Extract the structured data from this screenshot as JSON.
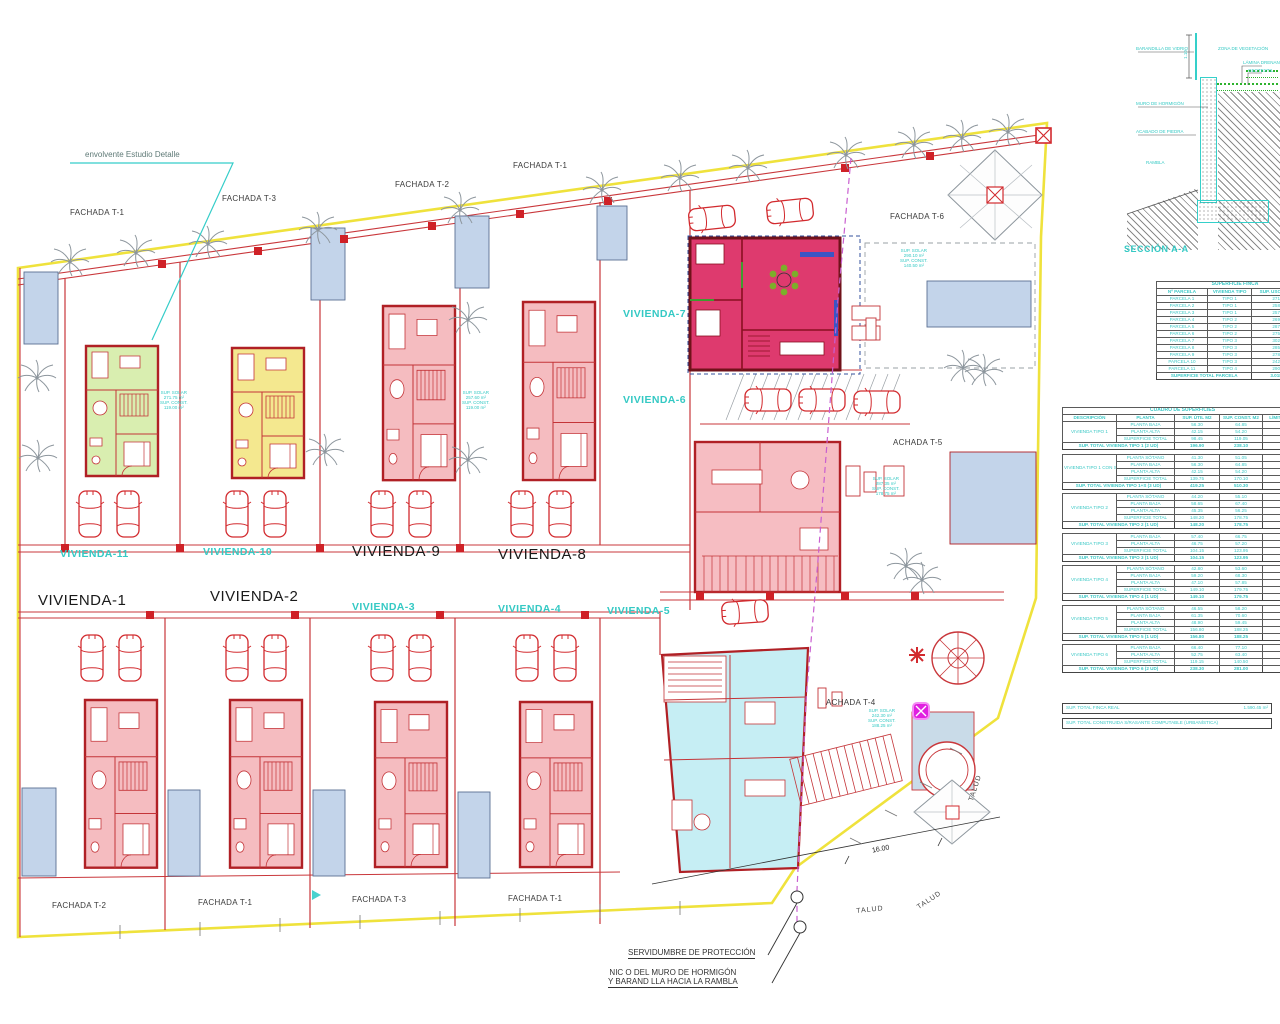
{
  "plan": {
    "viviendas": {
      "v1": "VIVIENDA-1",
      "v2": "VIVIENDA-2",
      "v3": "VIVIENDA-3",
      "v4": "VIVIENDA-4",
      "v5": "VIVIENDA-5",
      "v6": "VIVIENDA-6",
      "v7": "VIVIENDA-7",
      "v8": "VIVIENDA-8",
      "v9": "VIVIENDA-9",
      "v10": "VIVIENDA-10",
      "v11": "VIVIENDA-11"
    },
    "fachadas": {
      "top1": "FACHADA T-1",
      "top3": "FACHADA T-3",
      "top2": "FACHADA T-2",
      "top1b": "FACHADA T-1",
      "t6": "FACHADA T-6",
      "t5": "ACHADA T-5",
      "t4": "ACHADA T-4",
      "bot2": "FACHADA T-2",
      "bot1a": "FACHADA T-1",
      "bot3": "FACHADA T-3",
      "bot1b": "FACHADA T-1"
    },
    "notes": {
      "envolvente": "envolvente Estudio Detalle",
      "servidumbre": "SERVIDUMBRE DE PROTECCIÓN",
      "muro1": "NIC O DEL MURO DE HORMIGÓN",
      "muro2": "Y BARAND LLA HACIA LA RAMBLA",
      "dim": "16.00",
      "talud": "TALUD"
    },
    "annotations": [
      {
        "l1": "SUP. SOLAR",
        "l2": "271.75 m²",
        "l3": "SUP. CONST.",
        "l4": "119.00 m²"
      },
      {
        "l1": "SUP. SOLAR",
        "l2": "257.60 m²",
        "l3": "SUP. CONST.",
        "l4": "119.00 m²"
      },
      {
        "l1": "SUP. SOLAR",
        "l2": "290.10 m²",
        "l3": "SUP. CONST.",
        "l4": "140.50 m²"
      },
      {
        "l1": "SUP. SOLAR",
        "l2": "287.35 m²",
        "l3": "SUP. CONST.",
        "l4": "178.75 m²"
      },
      {
        "l1": "SUP. SOLAR",
        "l2": "242.30 m²",
        "l3": "SUP. CONST.",
        "l4": "188.25 m²"
      }
    ]
  },
  "section": {
    "title": "SECCIÓN A-A",
    "dim": "1.10",
    "l1": "BARANDILLA DE VIDRIO",
    "l2": "ZONA DE VEGETACIÓN",
    "l3": "LÁMINA DRENANTE",
    "l4": "GEOTEXTIL",
    "l5": "MURO DE HORMIGÓN",
    "l6": "ACABADO DE PIEDRA",
    "l7": "RAMBLA"
  },
  "tables": {
    "finca_rows": [
      {
        "type": "title",
        "cells": [
          {
            "t": "SUPERFICIE FINCA",
            "cs": 3
          }
        ]
      },
      {
        "type": "head",
        "cells": [
          {
            "t": "Nº PARCELA"
          },
          {
            "t": "VIVIENDA TIPO"
          },
          {
            "t": "SUP. USO DE SUELO"
          }
        ]
      },
      {
        "cells": [
          {
            "t": "PARCELA 1"
          },
          {
            "t": "TIPO 1"
          },
          {
            "t": "271.75 m²"
          }
        ]
      },
      {
        "cells": [
          {
            "t": "PARCELA 2"
          },
          {
            "t": "TIPO 1"
          },
          {
            "t": "258.20 m²"
          }
        ]
      },
      {
        "cells": [
          {
            "t": "PARCELA 3"
          },
          {
            "t": "TIPO 1"
          },
          {
            "t": "257.60 m²"
          }
        ]
      },
      {
        "cells": [
          {
            "t": "PARCELA 4"
          },
          {
            "t": "TIPO 2"
          },
          {
            "t": "269.15 m²"
          }
        ]
      },
      {
        "cells": [
          {
            "t": "PARCELA 5"
          },
          {
            "t": "TIPO 2"
          },
          {
            "t": "287.35 m²"
          }
        ]
      },
      {
        "cells": [
          {
            "t": "PARCELA 6"
          },
          {
            "t": "TIPO 2"
          },
          {
            "t": "275.90 m²"
          }
        ]
      },
      {
        "cells": [
          {
            "t": "PARCELA 7"
          },
          {
            "t": "TIPO 3"
          },
          {
            "t": "302.25 m²"
          }
        ]
      },
      {
        "cells": [
          {
            "t": "PARCELA 8"
          },
          {
            "t": "TIPO 3"
          },
          {
            "t": "285.40 m²"
          }
        ]
      },
      {
        "cells": [
          {
            "t": "PARCELA 9"
          },
          {
            "t": "TIPO 3"
          },
          {
            "t": "278.45 m²"
          }
        ]
      },
      {
        "cells": [
          {
            "t": "PARCELA 10"
          },
          {
            "t": "TIPO 3"
          },
          {
            "t": "242.30 m²"
          }
        ]
      },
      {
        "cells": [
          {
            "t": "PARCELA 11"
          },
          {
            "t": "TIPO 4"
          },
          {
            "t": "290.10 m²"
          }
        ]
      },
      {
        "type": "total",
        "cells": [
          {
            "t": "SUPERFICIE TOTAL PARCELA",
            "cs": 2
          },
          {
            "t": "3.018.45 m²"
          }
        ]
      }
    ],
    "sup_rows": [
      {
        "type": "title",
        "cells": [
          {
            "t": "CUADRO DE SUPERFICIES",
            "cs": 5
          }
        ]
      },
      {
        "type": "head",
        "cells": [
          {
            "t": "DESCRIPCIÓN"
          },
          {
            "t": "PLANTA"
          },
          {
            "t": "SUP. ÚTIL M2"
          },
          {
            "t": "SUP. CONST. M2"
          },
          {
            "t": "LÍMITE SUP."
          }
        ]
      },
      {
        "cells": [
          {
            "t": "VIVIENDA TIPO 1",
            "rs": 3
          },
          {
            "t": "PLANTA BAJA"
          },
          {
            "t": "56.30"
          },
          {
            "t": "64.85"
          },
          {
            "t": ""
          }
        ]
      },
      {
        "cells": [
          {
            "t": "PLANTA ALTA"
          },
          {
            "t": "42.15"
          },
          {
            "t": "54.20"
          },
          {
            "t": ""
          }
        ]
      },
      {
        "cells": [
          {
            "t": "SUPERFICIE TOTAL"
          },
          {
            "t": "98.45"
          },
          {
            "t": "119.05"
          },
          {
            "t": ""
          }
        ]
      },
      {
        "type": "total",
        "cells": [
          {
            "t": "SUP. TOTAL VIVIENDA TIPO 1 (2 UD)",
            "cs": 2
          },
          {
            "t": "196.90"
          },
          {
            "t": "238.10"
          },
          {
            "t": ""
          }
        ]
      },
      {
        "type": "gap",
        "cells": [
          {
            "t": "",
            "cs": 5
          }
        ]
      },
      {
        "cells": [
          {
            "t": "VIVIENDA TIPO 1 CON SÓTANO",
            "rs": 4
          },
          {
            "t": "PLANTA SÓTANO"
          },
          {
            "t": "41.30"
          },
          {
            "t": "51.05"
          },
          {
            "t": ""
          }
        ]
      },
      {
        "cells": [
          {
            "t": "PLANTA BAJA"
          },
          {
            "t": "56.30"
          },
          {
            "t": "64.85"
          },
          {
            "t": ""
          }
        ]
      },
      {
        "cells": [
          {
            "t": "PLANTA ALTA"
          },
          {
            "t": "42.15"
          },
          {
            "t": "54.20"
          },
          {
            "t": ""
          }
        ]
      },
      {
        "cells": [
          {
            "t": "SUPERFICIE TOTAL"
          },
          {
            "t": "139.75"
          },
          {
            "t": "170.10"
          },
          {
            "t": ""
          }
        ]
      },
      {
        "type": "total",
        "cells": [
          {
            "t": "SUP. TOTAL VIVIENDA TIPO 1+S (3 UD)",
            "cs": 2
          },
          {
            "t": "419.25"
          },
          {
            "t": "510.30"
          },
          {
            "t": ""
          }
        ]
      },
      {
        "type": "gap",
        "cells": [
          {
            "t": "",
            "cs": 5
          }
        ]
      },
      {
        "cells": [
          {
            "t": "VIVIENDA TIPO 2",
            "rs": 4
          },
          {
            "t": "PLANTA SÓTANO"
          },
          {
            "t": "44.20"
          },
          {
            "t": "55.10"
          },
          {
            "t": ""
          }
        ]
      },
      {
        "cells": [
          {
            "t": "PLANTA BAJA"
          },
          {
            "t": "58.65"
          },
          {
            "t": "67.40"
          },
          {
            "t": ""
          }
        ]
      },
      {
        "cells": [
          {
            "t": "PLANTA ALTA"
          },
          {
            "t": "45.35"
          },
          {
            "t": "56.25"
          },
          {
            "t": ""
          }
        ]
      },
      {
        "cells": [
          {
            "t": "SUPERFICIE TOTAL"
          },
          {
            "t": "148.20"
          },
          {
            "t": "178.75"
          },
          {
            "t": ""
          }
        ]
      },
      {
        "type": "total",
        "cells": [
          {
            "t": "SUP. TOTAL VIVIENDA TIPO 2 (1 UD)",
            "cs": 2
          },
          {
            "t": "148.20"
          },
          {
            "t": "178.75"
          },
          {
            "t": ""
          }
        ]
      },
      {
        "type": "gap",
        "cells": [
          {
            "t": "",
            "cs": 5
          }
        ]
      },
      {
        "cells": [
          {
            "t": "VIVIENDA TIPO 3",
            "rs": 3
          },
          {
            "t": "PLANTA BAJA"
          },
          {
            "t": "57.40"
          },
          {
            "t": "66.75"
          },
          {
            "t": ""
          }
        ]
      },
      {
        "cells": [
          {
            "t": "PLANTA ALTA"
          },
          {
            "t": "46.75"
          },
          {
            "t": "57.20"
          },
          {
            "t": ""
          }
        ]
      },
      {
        "cells": [
          {
            "t": "SUPERFICIE TOTAL"
          },
          {
            "t": "104.15"
          },
          {
            "t": "123.95"
          },
          {
            "t": ""
          }
        ]
      },
      {
        "type": "total",
        "cells": [
          {
            "t": "SUP. TOTAL VIVIENDA TIPO 3 (1 UD)",
            "cs": 2
          },
          {
            "t": "104.15"
          },
          {
            "t": "123.95"
          },
          {
            "t": ""
          }
        ]
      },
      {
        "type": "gap",
        "cells": [
          {
            "t": "",
            "cs": 5
          }
        ]
      },
      {
        "cells": [
          {
            "t": "VIVIENDA TIPO 4",
            "rs": 4
          },
          {
            "t": "PLANTA SÓTANO"
          },
          {
            "t": "42.80"
          },
          {
            "t": "53.60"
          },
          {
            "t": ""
          }
        ]
      },
      {
        "cells": [
          {
            "t": "PLANTA BAJA"
          },
          {
            "t": "59.20"
          },
          {
            "t": "68.30"
          },
          {
            "t": ""
          }
        ]
      },
      {
        "cells": [
          {
            "t": "PLANTA ALTA"
          },
          {
            "t": "47.10"
          },
          {
            "t": "57.85"
          },
          {
            "t": ""
          }
        ]
      },
      {
        "cells": [
          {
            "t": "SUPERFICIE TOTAL"
          },
          {
            "t": "149.10"
          },
          {
            "t": "179.75"
          },
          {
            "t": ""
          }
        ]
      },
      {
        "type": "total",
        "cells": [
          {
            "t": "SUP. TOTAL VIVIENDA TIPO 4 (1 UD)",
            "cs": 2
          },
          {
            "t": "149.10"
          },
          {
            "t": "179.75"
          },
          {
            "t": ""
          }
        ]
      },
      {
        "type": "gap",
        "cells": [
          {
            "t": "",
            "cs": 5
          }
        ]
      },
      {
        "cells": [
          {
            "t": "VIVIENDA TIPO 5",
            "rs": 4
          },
          {
            "t": "PLANTA SÓTANO"
          },
          {
            "t": "46.55"
          },
          {
            "t": "58.20"
          },
          {
            "t": ""
          }
        ]
      },
      {
        "cells": [
          {
            "t": "PLANTA BAJA"
          },
          {
            "t": "61.35"
          },
          {
            "t": "70.60"
          },
          {
            "t": ""
          }
        ]
      },
      {
        "cells": [
          {
            "t": "PLANTA ALTA"
          },
          {
            "t": "48.90"
          },
          {
            "t": "59.45"
          },
          {
            "t": ""
          }
        ]
      },
      {
        "cells": [
          {
            "t": "SUPERFICIE TOTAL"
          },
          {
            "t": "156.80"
          },
          {
            "t": "188.25"
          },
          {
            "t": ""
          }
        ]
      },
      {
        "type": "total",
        "cells": [
          {
            "t": "SUP. TOTAL VIVIENDA TIPO 5 (1 UD)",
            "cs": 2
          },
          {
            "t": "156.80"
          },
          {
            "t": "188.25"
          },
          {
            "t": ""
          }
        ]
      },
      {
        "type": "gap",
        "cells": [
          {
            "t": "",
            "cs": 5
          }
        ]
      },
      {
        "cells": [
          {
            "t": "VIVIENDA TIPO 6",
            "rs": 3
          },
          {
            "t": "PLANTA BAJA"
          },
          {
            "t": "66.40"
          },
          {
            "t": "77.10"
          },
          {
            "t": ""
          }
        ]
      },
      {
        "cells": [
          {
            "t": "PLANTA ALTA"
          },
          {
            "t": "52.75"
          },
          {
            "t": "63.40"
          },
          {
            "t": ""
          }
        ]
      },
      {
        "cells": [
          {
            "t": "SUPERFICIE TOTAL"
          },
          {
            "t": "119.15"
          },
          {
            "t": "140.50"
          },
          {
            "t": ""
          }
        ]
      },
      {
        "type": "total",
        "cells": [
          {
            "t": "SUP. TOTAL VIVIENDA TIPO 6 (2 UD)",
            "cs": 2
          },
          {
            "t": "238.30"
          },
          {
            "t": "281.00"
          },
          {
            "t": ""
          }
        ]
      }
    ],
    "bar1_label": "SUP. TOTAL FINCA REAL",
    "bar1_value": "1.590.45 m²",
    "bar2_label": "SUP. TOTAL CONSTRUIDA S/RASANTE COMPUTABLE (URBANÍSTICA)",
    "bar2_value": ""
  }
}
